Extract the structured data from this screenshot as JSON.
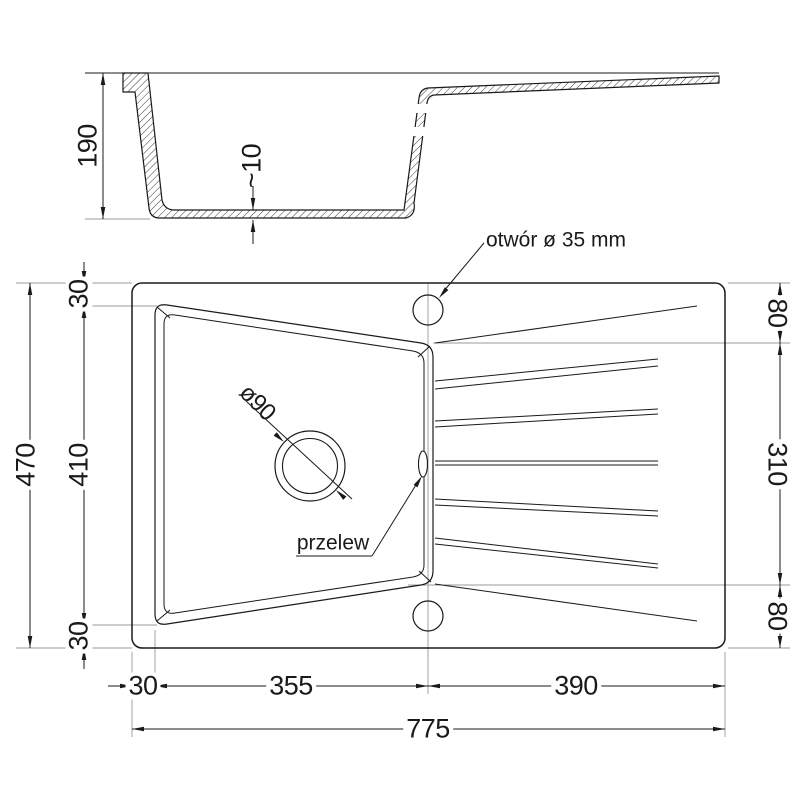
{
  "drawing": {
    "type": "sink-technical-drawing",
    "views": [
      "cross-section",
      "top-view"
    ],
    "units": "mm"
  },
  "dims": {
    "bowl_depth": "190",
    "bottom_thickness": "~10",
    "total_height": "470",
    "bowl_opening_height": "410",
    "rim_top": "30",
    "rim_bottom": "30",
    "board_top": "80",
    "board_mid": "310",
    "board_bottom": "80",
    "margin_left": "30",
    "bowl_width": "355",
    "board_width": "390",
    "total_width": "775",
    "drain_hole": "ø90"
  },
  "labels": {
    "tap_hole": "otwór ø 35 mm",
    "overflow": "przelew"
  },
  "colors": {
    "line": "#1a1a1a",
    "extension": "#999999",
    "background": "#ffffff"
  }
}
